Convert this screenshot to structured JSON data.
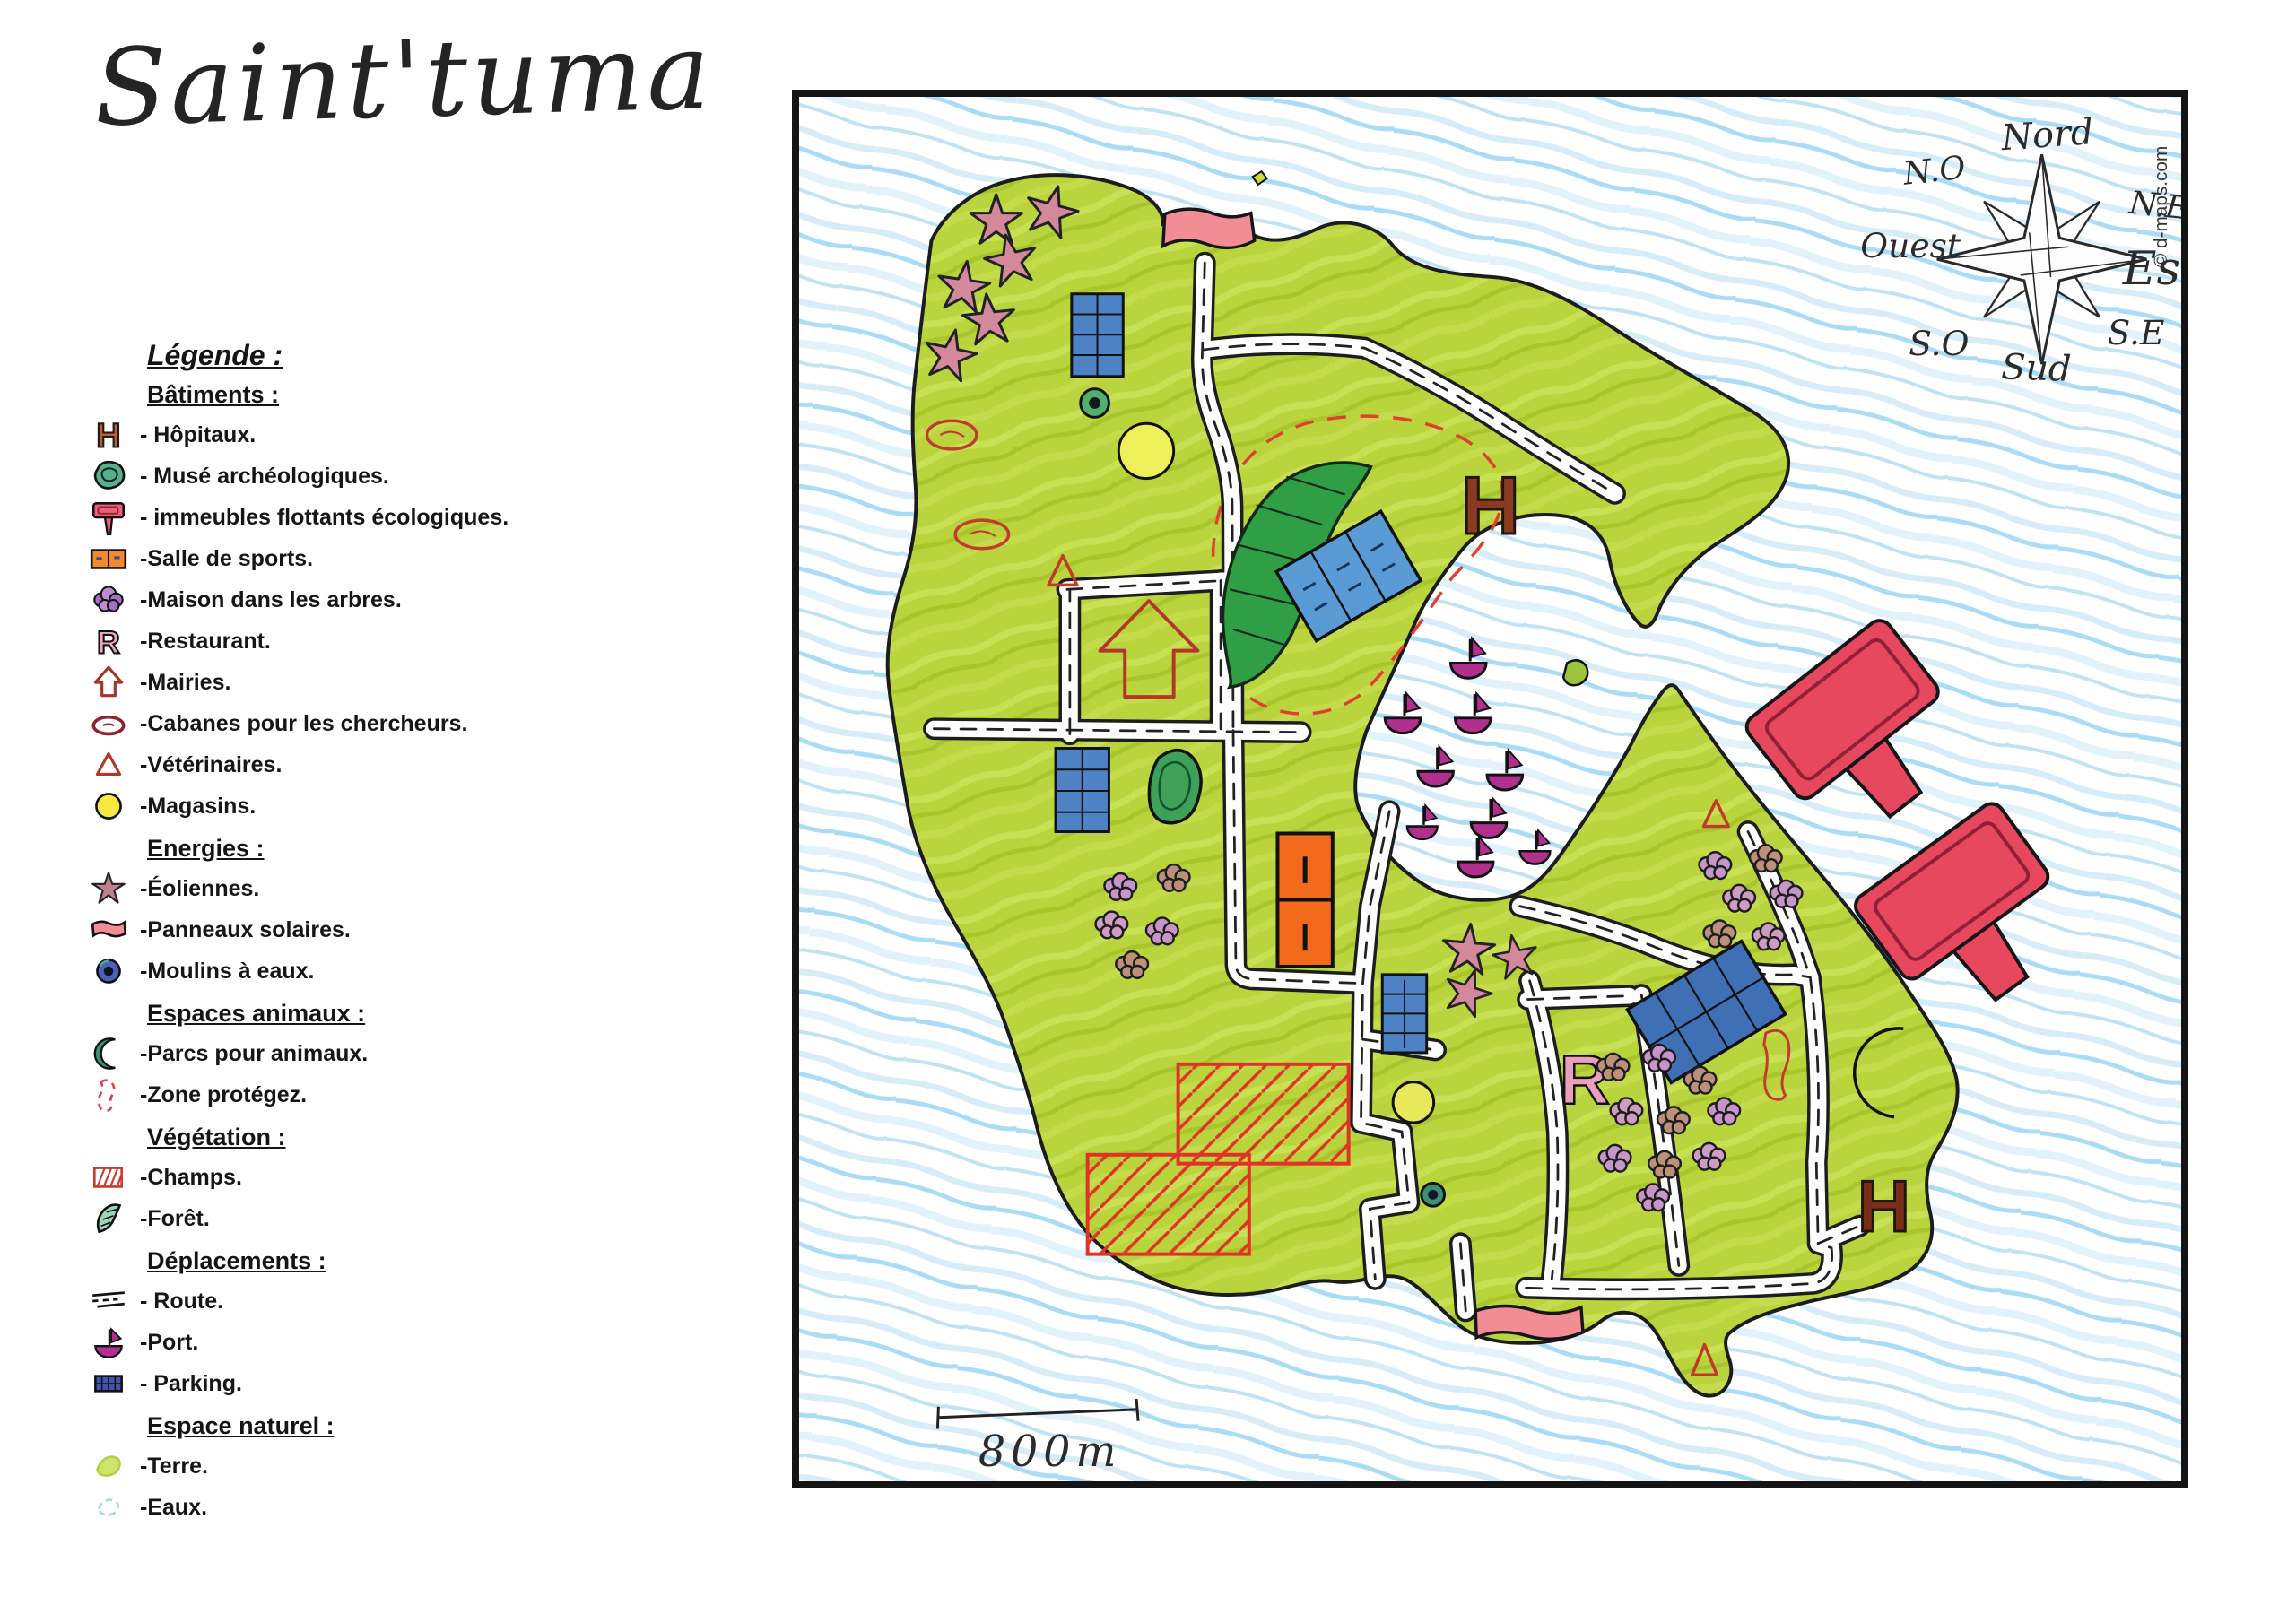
{
  "title": "Saint'tuma",
  "map": {
    "copyright": "© d-maps.com",
    "scale": {
      "label": "800m"
    },
    "compass": {
      "north": "Nord",
      "north_east": "N.E",
      "east": "Est",
      "south_east": "S.E",
      "south": "Sud",
      "south_west": "S.O",
      "west": "Ouest",
      "north_west": "N.O"
    },
    "features": {
      "hospitals": 2,
      "museums": 1,
      "floating_buildings": 2,
      "sports_halls": 1,
      "tree_house_groups": 3,
      "restaurants": 1,
      "town_halls": 1,
      "researcher_cabins": 3,
      "vets": 3,
      "shops": 2,
      "wind_turbines": 9,
      "solar_panels": 3,
      "water_mills": 2,
      "animal_parks": 1,
      "protected_zones": 1,
      "fields": 2,
      "forests": 1,
      "boats_in_port": 9,
      "parkings": 4
    },
    "colors": {
      "land": "#b9d43c",
      "water_streak": "#aadcf5",
      "forest": "#2f9e44",
      "floating_building": "#e8485e",
      "hospital": "#8a3a20",
      "road": "#fdfdfd",
      "field_hatch": "#e03226",
      "boat": "#b1308d",
      "protected_zone": "#e0402e"
    }
  },
  "legend": {
    "title": "Légende :",
    "sections": [
      {
        "title": "Bâtiments :",
        "items": [
          {
            "icon": "hospital-h",
            "label": "- Hôpitaux."
          },
          {
            "icon": "museum-blob",
            "label": "- Musé archéologiques."
          },
          {
            "icon": "floating-building-t",
            "label": "- immeubles flottants écologiques."
          },
          {
            "icon": "sports-hall",
            "label": "-Salle de sports."
          },
          {
            "icon": "tree-house",
            "label": "-Maison dans les arbres."
          },
          {
            "icon": "restaurant-r",
            "label": "-Restaurant."
          },
          {
            "icon": "town-hall-arrow",
            "label": "-Mairies."
          },
          {
            "icon": "researcher-cabin",
            "label": "-Cabanes pour les chercheurs."
          },
          {
            "icon": "vet-triangle",
            "label": "-Vétérinaires."
          },
          {
            "icon": "shop-circle",
            "label": "-Magasins."
          }
        ]
      },
      {
        "title": "Energies :",
        "items": [
          {
            "icon": "wind-turbine-star",
            "label": "-Éoliennes."
          },
          {
            "icon": "solar-panel",
            "label": "-Panneaux solaires."
          },
          {
            "icon": "water-mill",
            "label": "-Moulins à eaux."
          }
        ]
      },
      {
        "title": "Espaces animaux :",
        "items": [
          {
            "icon": "animal-park-crescent",
            "label": "-Parcs pour animaux."
          },
          {
            "icon": "protected-zone",
            "label": "-Zone protégez."
          }
        ]
      },
      {
        "title": "Végétation :",
        "items": [
          {
            "icon": "field-hatch",
            "label": "-Champs."
          },
          {
            "icon": "forest-leaf",
            "label": "-Forêt."
          }
        ]
      },
      {
        "title": "Déplacements :",
        "items": [
          {
            "icon": "road-dashes",
            "label": "- Route."
          },
          {
            "icon": "port-boat",
            "label": "-Port."
          },
          {
            "icon": "parking-grid",
            "label": "- Parking."
          }
        ]
      },
      {
        "title": "Espace naturel :",
        "items": [
          {
            "icon": "land-scribble",
            "label": "-Terre."
          },
          {
            "icon": "water-scribble",
            "label": "-Eaux."
          }
        ]
      }
    ]
  }
}
